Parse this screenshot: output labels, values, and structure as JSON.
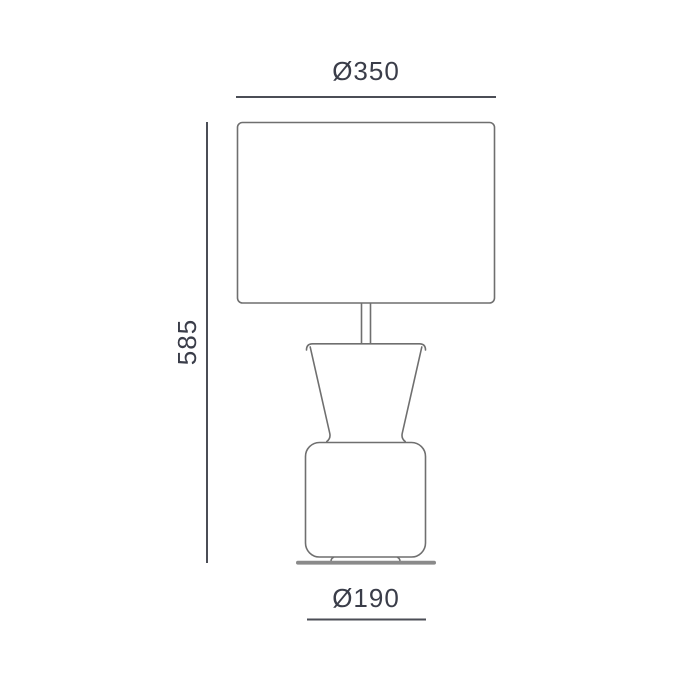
{
  "drawing": {
    "name": "table-lamp-technical-dimension-drawing",
    "labels": {
      "shade_diameter": "Ø350",
      "height": "585",
      "base_diameter": "Ø190"
    },
    "values": {
      "shade_diameter": 350,
      "height": 585,
      "base_diameter": 190
    },
    "colors": {
      "background": "#ffffff",
      "outline": "#6f6f6f",
      "dimension_line": "#4b4e56",
      "label_text": "#3a3d49",
      "base_fill": "#8a8a8a"
    },
    "parts": [
      "lampshade",
      "stem",
      "cone-neck",
      "body",
      "feet",
      "base-plate"
    ]
  }
}
